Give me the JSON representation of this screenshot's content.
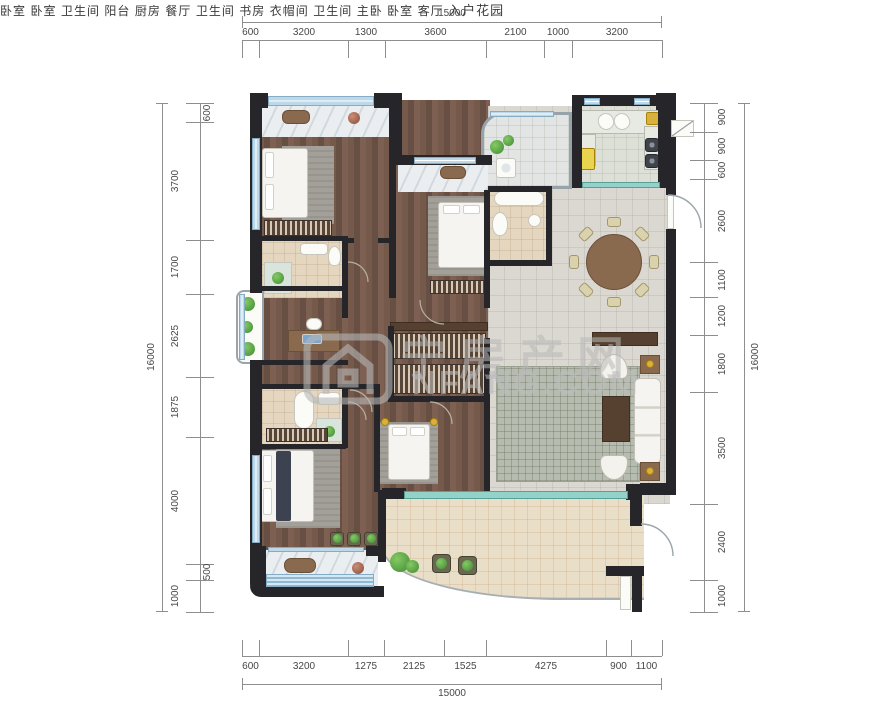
{
  "watermark": {
    "logo": "house-logo",
    "cn": "宁房产网",
    "en": "NFANG.COM"
  },
  "dims": {
    "top": {
      "total": "15000",
      "segments": [
        "600",
        "3200",
        "1300",
        "3600",
        "2100",
        "1000",
        "3200"
      ]
    },
    "bottom": {
      "total": "15000",
      "segments": [
        "600",
        "3200",
        "1275",
        "2125",
        "1525",
        "4275",
        "900",
        "1100"
      ]
    },
    "left": {
      "total": "16000",
      "segments": [
        "600",
        "3700",
        "1700",
        "2625",
        "1875",
        "4000",
        "500",
        "1000"
      ]
    },
    "right": {
      "total": "16000",
      "segments": [
        "900",
        "900",
        "600",
        "2600",
        "1100",
        "1200",
        "1800",
        "3500",
        "2400",
        "1000"
      ]
    }
  },
  "rooms": [
    {
      "id": "bedroom-1",
      "label": "卧室"
    },
    {
      "id": "bedroom-2",
      "label": "卧室"
    },
    {
      "id": "bathroom-1",
      "label": "卫生间"
    },
    {
      "id": "balcony",
      "label": "阳台"
    },
    {
      "id": "kitchen",
      "label": "厨房"
    },
    {
      "id": "dining-room",
      "label": "餐厅"
    },
    {
      "id": "bathroom-2",
      "label": "卫生间"
    },
    {
      "id": "study",
      "label": "书房"
    },
    {
      "id": "closet",
      "label": "衣帽间"
    },
    {
      "id": "bathroom-3",
      "label": "卫生间"
    },
    {
      "id": "master-bedroom",
      "label": "主卧"
    },
    {
      "id": "bedroom-3",
      "label": "卧室"
    },
    {
      "id": "living-room",
      "label": "客厅"
    },
    {
      "id": "entry-garden",
      "label": "入户花园"
    }
  ],
  "colors": {
    "wall": "#26262a",
    "window": "#bdd9e9",
    "wood_floor": "#6f574a",
    "tile_floor": "#dbd8d1",
    "garden_floor": "#e9dec7",
    "watermark": "#bababa"
  }
}
